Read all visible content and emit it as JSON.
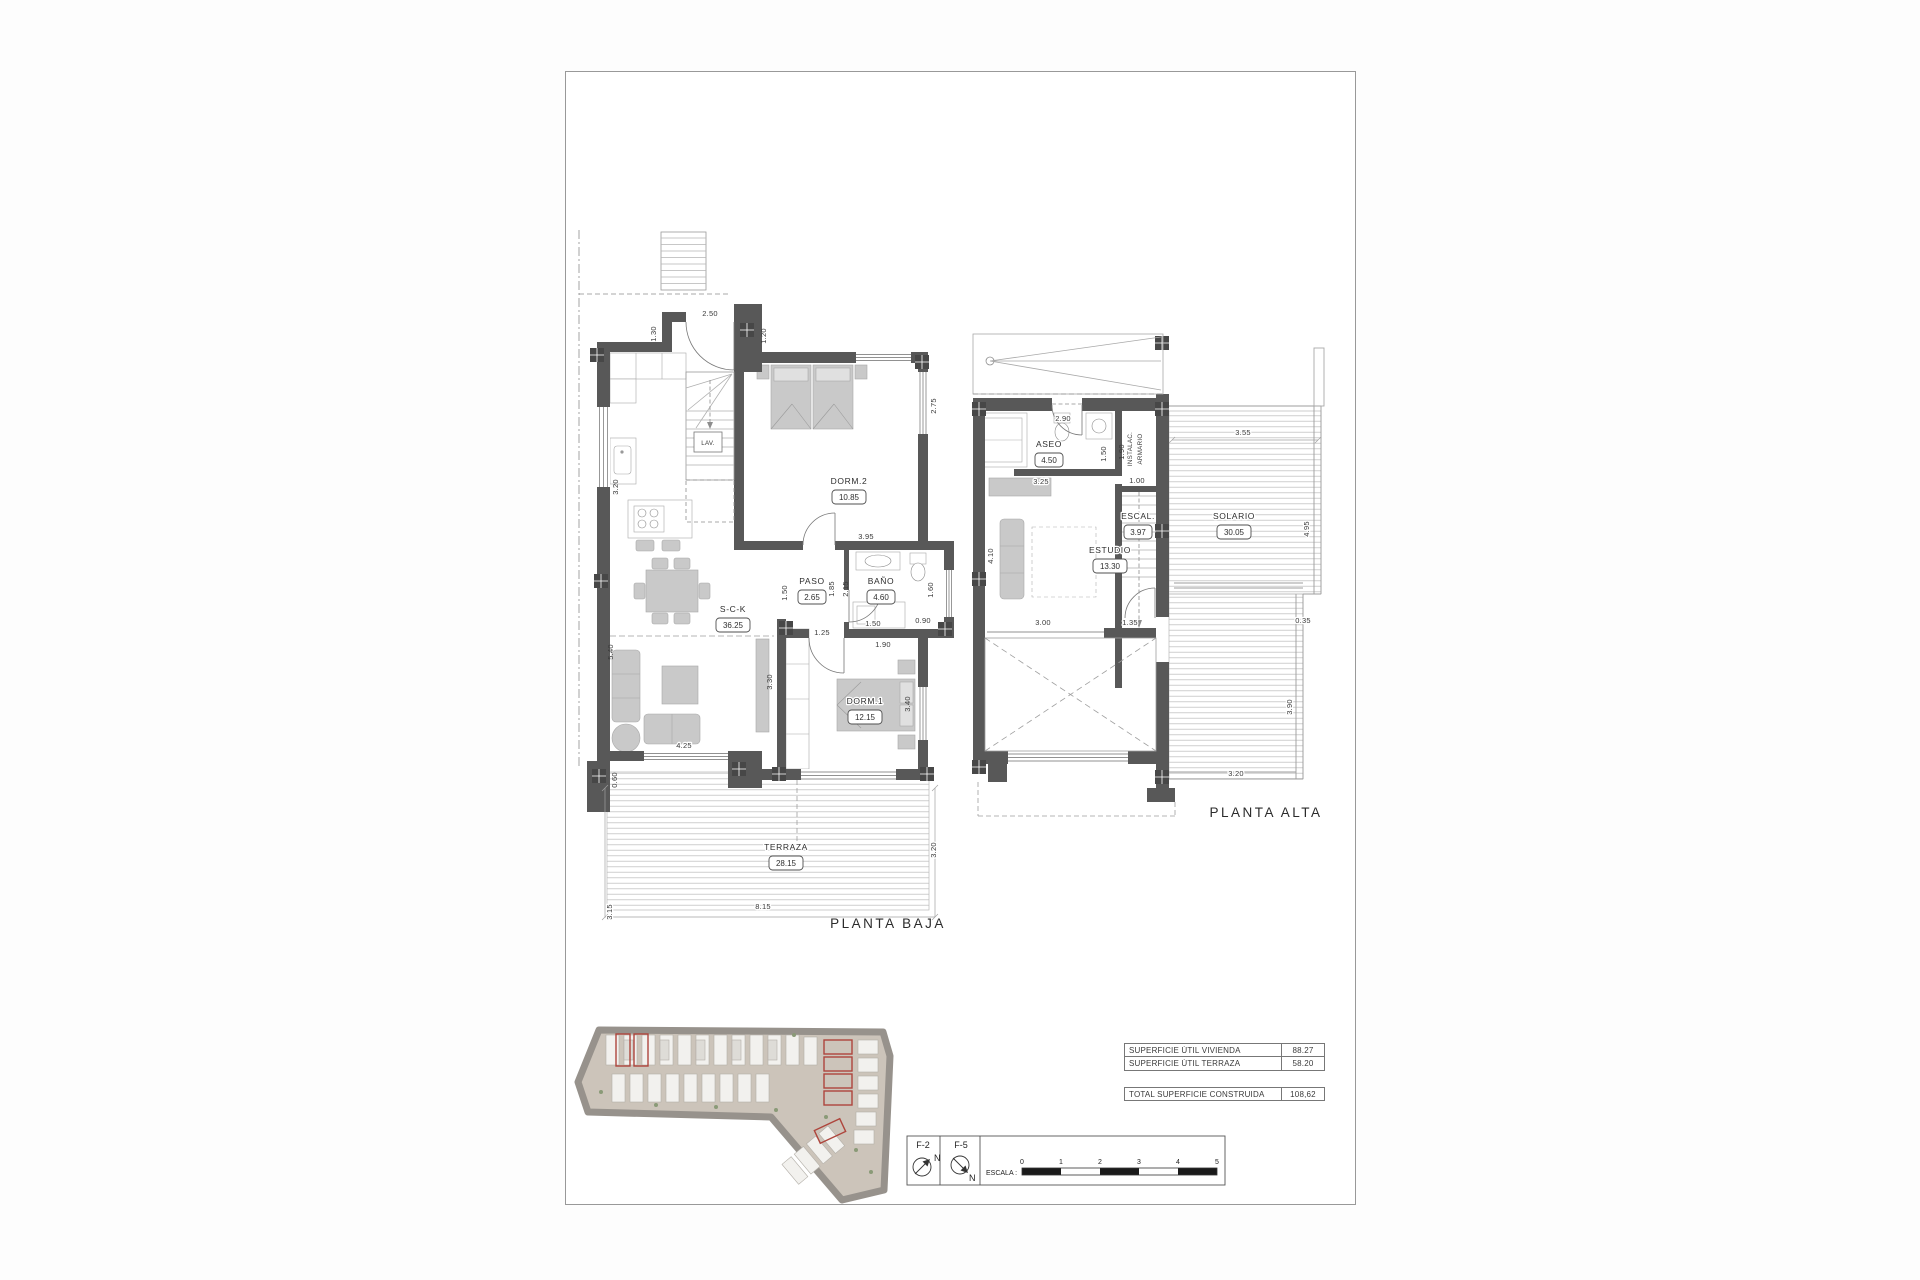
{
  "pb": {
    "title": "PLANTA BAJA",
    "rooms": {
      "sck": {
        "n": "S-C-K",
        "a": "36.25"
      },
      "paso": {
        "n": "PASO",
        "a": "2.65"
      },
      "bano": {
        "n": "BAÑO",
        "a": "4.60"
      },
      "dorm1": {
        "n": "DORM.1",
        "a": "12.15"
      },
      "dorm2": {
        "n": "DORM.2",
        "a": "10.85"
      },
      "terraza": {
        "n": "TERRAZA",
        "a": "28.15"
      },
      "lav": {
        "n": "LAV."
      }
    },
    "dims": {
      "d250": "2.50",
      "d130": "1.30",
      "d120": "1.20",
      "d320k": "3.20",
      "d540": "5.40",
      "d060": "0.60",
      "d425": "4.25",
      "d330": "3.30",
      "d125": "1.25",
      "d150p": "1.50",
      "d185": "1.85",
      "d215": "2.15",
      "d395": "3.95",
      "d275": "2.75",
      "d160": "1.60",
      "d090": "0.90",
      "d150b": "1.50",
      "d190": "1.90",
      "d340": "3.40",
      "d315": "3.15",
      "d815": "8.15",
      "d320t": "3.20"
    }
  },
  "pa": {
    "title": "PLANTA ALTA",
    "rooms": {
      "aseo": {
        "n": "ASEO",
        "a": "4.50"
      },
      "estudio": {
        "n": "ESTUDIO",
        "a": "13.30"
      },
      "escal": {
        "n": "ESCAL.",
        "a": "3.97"
      },
      "solario": {
        "n": "SOLARIO",
        "a": "30.05"
      },
      "instalac": {
        "l1": "INSTALAC.",
        "l2": "ARMARIO"
      }
    },
    "dims": {
      "d290": "2.90",
      "d150": "1.50",
      "d190": "1.90",
      "d100": "1.00",
      "d325": "3.25",
      "d410": "4.10",
      "d355": "3.55",
      "d495": "4.95",
      "d035": "0.35",
      "d300": "3.00",
      "d135": "1.35",
      "d390": "3.90",
      "d320": "3.20"
    }
  },
  "tables": {
    "rows": [
      {
        "label": "SUPERFICIE ÚTIL VIVIENDA",
        "value": "88.27"
      },
      {
        "label": "SUPERFICIE ÚTIL TERRAZA",
        "value": "58.20"
      }
    ],
    "total": {
      "label": "TOTAL SUPERFICIE CONSTRUIDA",
      "value": "108,62"
    }
  },
  "legend": {
    "f2": "F-2",
    "f5": "F-5",
    "north": "N",
    "escala": "ESCALA :",
    "ticks": [
      "0",
      "1",
      "2",
      "3",
      "4",
      "5"
    ]
  },
  "colors": {
    "wall": "#585858",
    "furniture": "#c9c9c9",
    "site_fill": "#ccc4ba",
    "site_rim": "#97928c",
    "highlight_red": "#ae453c"
  }
}
